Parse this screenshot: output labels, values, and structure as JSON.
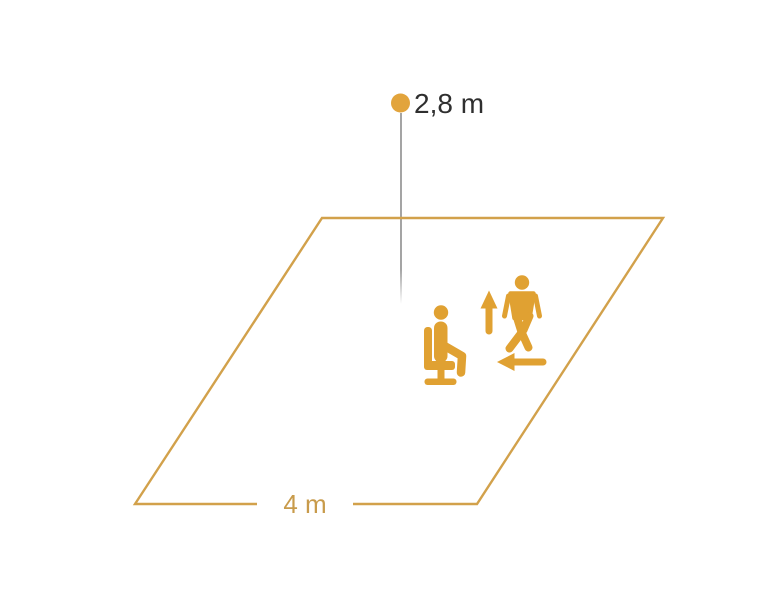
{
  "diagram": {
    "type": "sensor-mounting-detection-area-diagram",
    "height_label": "2,8 m",
    "width_label": "4 m",
    "icons": [
      "sensor-point",
      "height-drop-line",
      "detection-area-floor",
      "seated-person-icon",
      "walking-person-icon",
      "up-arrow-icon",
      "left-arrow-icon"
    ],
    "colors": {
      "accent_orange": "#E0A132",
      "dot_orange": "#E2A43C",
      "outline_orange": "#D2A14B",
      "label_orange": "#C89B4B",
      "height_text": "#2F2F2F",
      "height_line_gray": "#8E8E8E",
      "background": "#FFFFFF"
    }
  }
}
